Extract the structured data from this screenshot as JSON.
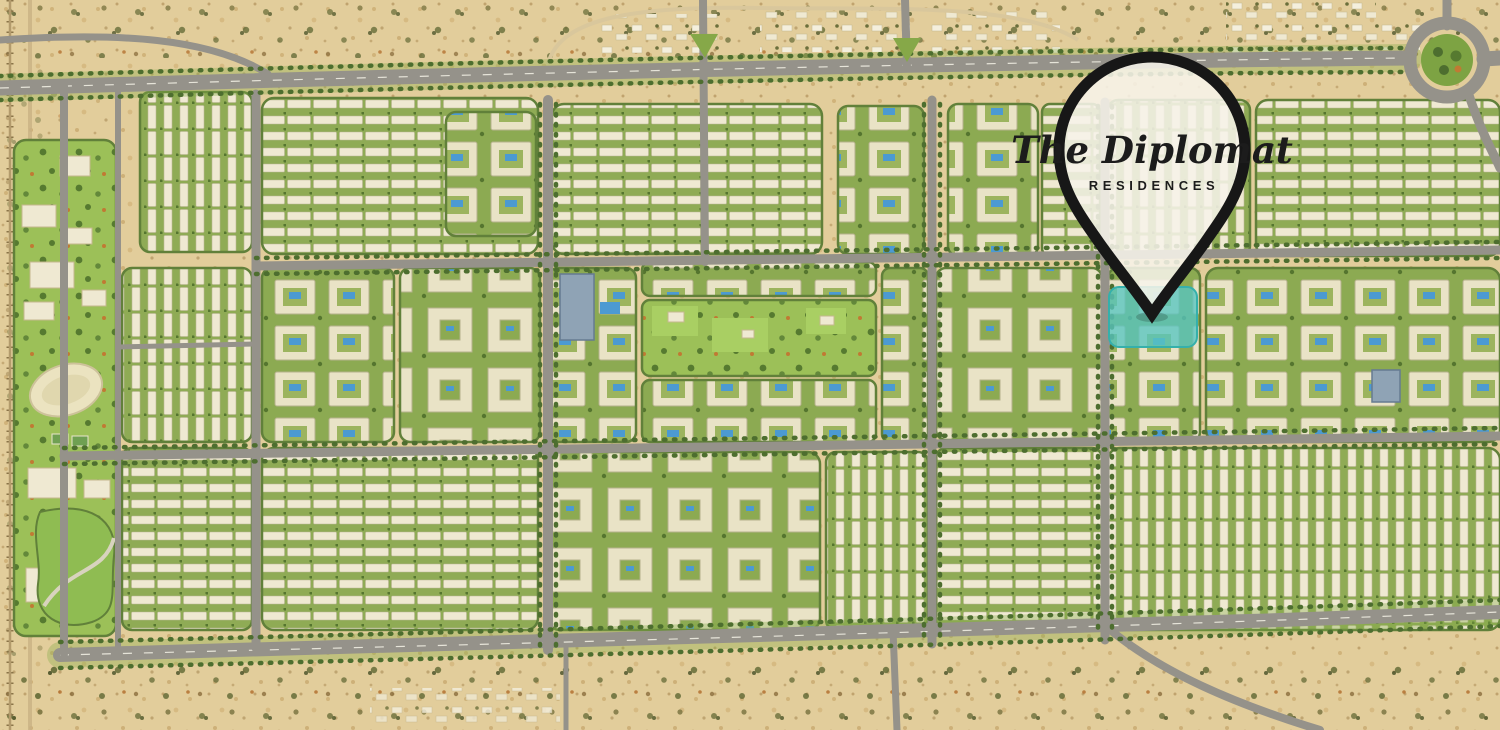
{
  "marker": {
    "title": "The Diplomat",
    "subtitle": "RESIDENCES"
  },
  "colors": {
    "sand": "#e2cd9b",
    "speckle": "#b3925c",
    "road": "#95928a",
    "road_marking": "#f5f2e6",
    "greenery": "#8fab55",
    "lawn": "#9cc058",
    "tree": "#4d6e2f",
    "building": "#efe9d2",
    "apartment": "#e9e3c6",
    "pool": "#4c9ad2",
    "highlight": "#57c5c0",
    "roundabout_green": "#7da343",
    "highrise": "#8fa3b5",
    "autumn_tree": "#c07a33",
    "pin_outline": "#171717",
    "pin_fill": "#f7f4ea",
    "pin_text": "#1c1c1c"
  },
  "features": [
    "desert-surroundings",
    "railway-line",
    "top-highway",
    "bottom-highway",
    "internal-road-grid",
    "roundabout",
    "existing-village-structures",
    "townhouse-blocks",
    "apartment-blocks",
    "courtyard-apartment-blocks",
    "central-park",
    "sports-stadium",
    "tennis-courts",
    "school-campus",
    "community-park",
    "swimming-pools",
    "highlighted-plot",
    "location-pin"
  ]
}
